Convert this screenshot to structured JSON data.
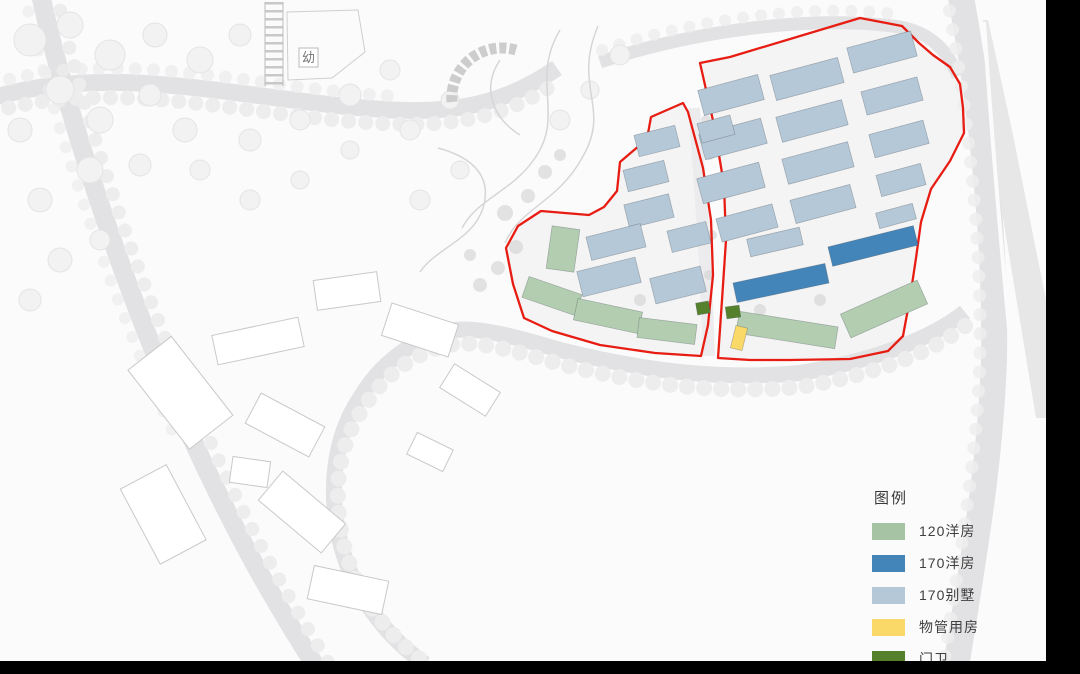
{
  "page": {
    "background_color": "#000000",
    "map_background_color": "#fbfbfb"
  },
  "map": {
    "kindergarten_label": "幼",
    "boundary_color": "#e71d13",
    "parcels": [
      {
        "name": "west",
        "points": "683,103 651,117 647,139 620,162 617,191 604,207 589,215 541,211 518,226 506,248 513,284 524,318 552,331 600,345 655,353 701,356 708,325 713,275 711,220 703,168 688,112"
      },
      {
        "name": "east",
        "points": "700,63 730,57 860,18 902,26 919,43 933,55 950,67 960,84 963,108 964,133 950,161 931,189 921,222 916,258 910,298 903,336 888,351 850,359 790,360 750,360 718,358 722,300 726,240 724,185 714,125"
      }
    ],
    "building_types": {
      "flat120": {
        "label": "120洋房",
        "color": "#b2cdb0"
      },
      "flat170": {
        "label": "170洋房",
        "color": "#4485b9"
      },
      "villa170": {
        "label": "170别墅",
        "color": "#b5c8d7"
      },
      "property": {
        "label": "物管用房",
        "color": "#fbd968"
      },
      "guard": {
        "label": "门卫",
        "color": "#55812d"
      }
    },
    "buildings": [
      {
        "type": "villa170",
        "x": 731,
        "y": 95,
        "w": 62,
        "h": 26,
        "r": -15
      },
      {
        "type": "villa170",
        "x": 807,
        "y": 79,
        "w": 70,
        "h": 26,
        "r": -15
      },
      {
        "type": "villa170",
        "x": 882,
        "y": 52,
        "w": 66,
        "h": 26,
        "r": -15
      },
      {
        "type": "villa170",
        "x": 733,
        "y": 139,
        "w": 64,
        "h": 26,
        "r": -15
      },
      {
        "type": "villa170",
        "x": 812,
        "y": 121,
        "w": 68,
        "h": 26,
        "r": -15
      },
      {
        "type": "villa170",
        "x": 892,
        "y": 96,
        "w": 58,
        "h": 24,
        "r": -15
      },
      {
        "type": "villa170",
        "x": 731,
        "y": 183,
        "w": 64,
        "h": 26,
        "r": -15
      },
      {
        "type": "villa170",
        "x": 818,
        "y": 163,
        "w": 68,
        "h": 26,
        "r": -15
      },
      {
        "type": "villa170",
        "x": 899,
        "y": 139,
        "w": 56,
        "h": 24,
        "r": -15
      },
      {
        "type": "villa170",
        "x": 747,
        "y": 223,
        "w": 58,
        "h": 24,
        "r": -15
      },
      {
        "type": "villa170",
        "x": 823,
        "y": 204,
        "w": 62,
        "h": 24,
        "r": -15
      },
      {
        "type": "villa170",
        "x": 901,
        "y": 180,
        "w": 46,
        "h": 22,
        "r": -15
      },
      {
        "type": "villa170",
        "x": 716,
        "y": 129,
        "w": 34,
        "h": 20,
        "r": -15
      },
      {
        "type": "villa170",
        "x": 775,
        "y": 242,
        "w": 54,
        "h": 18,
        "r": -13
      },
      {
        "type": "villa170",
        "x": 896,
        "y": 216,
        "w": 38,
        "h": 16,
        "r": -15
      },
      {
        "type": "villa170",
        "x": 657,
        "y": 141,
        "w": 42,
        "h": 22,
        "r": -14
      },
      {
        "type": "villa170",
        "x": 646,
        "y": 176,
        "w": 42,
        "h": 22,
        "r": -14
      },
      {
        "type": "villa170",
        "x": 649,
        "y": 211,
        "w": 46,
        "h": 24,
        "r": -14
      },
      {
        "type": "villa170",
        "x": 616,
        "y": 242,
        "w": 56,
        "h": 24,
        "r": -14
      },
      {
        "type": "villa170",
        "x": 609,
        "y": 277,
        "w": 60,
        "h": 26,
        "r": -14
      },
      {
        "type": "villa170",
        "x": 678,
        "y": 285,
        "w": 52,
        "h": 26,
        "r": -14
      },
      {
        "type": "villa170",
        "x": 689,
        "y": 237,
        "w": 40,
        "h": 22,
        "r": -14
      },
      {
        "type": "flat170",
        "x": 781,
        "y": 283,
        "w": 94,
        "h": 20,
        "r": -12
      },
      {
        "type": "flat170",
        "x": 873,
        "y": 246,
        "w": 88,
        "h": 20,
        "r": -14
      },
      {
        "type": "flat120",
        "x": 552,
        "y": 296,
        "w": 56,
        "h": 22,
        "r": 19
      },
      {
        "type": "flat120",
        "x": 608,
        "y": 316,
        "w": 66,
        "h": 22,
        "r": 12
      },
      {
        "type": "flat120",
        "x": 667,
        "y": 331,
        "w": 58,
        "h": 20,
        "r": 7
      },
      {
        "type": "flat120",
        "x": 563,
        "y": 249,
        "w": 28,
        "h": 43,
        "r": 8
      },
      {
        "type": "flat120",
        "x": 787,
        "y": 330,
        "w": 100,
        "h": 22,
        "r": 9
      },
      {
        "type": "flat120",
        "x": 884,
        "y": 309,
        "w": 84,
        "h": 26,
        "r": -24
      },
      {
        "type": "property",
        "x": 739,
        "y": 338,
        "w": 12,
        "h": 23,
        "r": 14
      },
      {
        "type": "guard",
        "x": 703,
        "y": 308,
        "w": 13,
        "h": 12,
        "r": -10
      },
      {
        "type": "guard",
        "x": 733,
        "y": 312,
        "w": 14,
        "h": 12,
        "r": -8
      }
    ]
  },
  "legend": {
    "title": "图例",
    "items": [
      {
        "key": "flat120",
        "label": "120洋房",
        "color": "#a6c3a3"
      },
      {
        "key": "flat170",
        "label": "170洋房",
        "color": "#4485b9"
      },
      {
        "key": "villa170",
        "label": "170别墅",
        "color": "#b5c8d7"
      },
      {
        "key": "property",
        "label": "物管用房",
        "color": "#fbd968"
      },
      {
        "key": "guard",
        "label": "门卫",
        "color": "#55812d"
      }
    ]
  }
}
